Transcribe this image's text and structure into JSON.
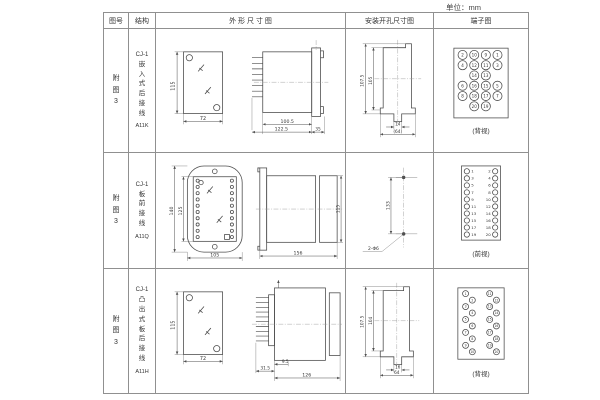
{
  "unit_label": "单位：mm",
  "table": {
    "headers": {
      "fig_no": "图号",
      "structure": "结构",
      "outline": "外 形 尺 寸 图",
      "install": "安装开孔尺寸图",
      "terminal": "端子图"
    },
    "rows": [
      {
        "fig_no": "附图3",
        "structure_model": "CJ-1",
        "structure_desc": "嵌入式后接线",
        "structure_code": "A11K",
        "outline": {
          "front_height": "115",
          "front_width": "72",
          "side_body": "100.5",
          "side_total": "122.5",
          "side_flange": "35"
        },
        "install": {
          "outer_height": "107.5",
          "inner_height": "105",
          "slot_width": "14",
          "opening_width": "(64)"
        },
        "terminal": {
          "view": "(背视)",
          "grid": [
            [
              2,
              10,
              9,
              1
            ],
            [
              4,
              12,
              11,
              3
            ],
            [
              null,
              14,
              13,
              null
            ],
            [
              6,
              16,
              15,
              5
            ],
            [
              8,
              18,
              17,
              7
            ],
            [
              null,
              20,
              19,
              null
            ]
          ]
        }
      },
      {
        "fig_no": "附图3",
        "structure_model": "CJ-1",
        "structure_desc": "板前接线",
        "structure_code": "A11Q",
        "outline": {
          "front_outer_height": "140",
          "front_inner_height": "125",
          "front_width": "105",
          "side_length": "156",
          "side_height": "115"
        },
        "install": {
          "hole_spacing": "133",
          "holes": "2-Φ6"
        },
        "terminal": {
          "view": "(前视)",
          "left_numbers": [
            1,
            3,
            5,
            7,
            9,
            11,
            13,
            15,
            17,
            19
          ],
          "right_numbers": [
            2,
            4,
            6,
            8,
            10,
            12,
            14,
            16,
            18,
            20
          ]
        }
      },
      {
        "fig_no": "附图3",
        "structure_model": "CJ-1",
        "structure_desc": "凸出式板后接线",
        "structure_code": "A11H",
        "outline": {
          "front_height": "115",
          "front_width": "72",
          "pin_depth": "31.5",
          "body_offset": "9.5",
          "side_length": "126"
        },
        "install": {
          "outer_height": "107.5",
          "inner_height": "104",
          "slot_width": "16",
          "opening_width": "64"
        },
        "terminal": {
          "view": "(背视)",
          "left_numbers": [
            1,
            2,
            3,
            4,
            5,
            6,
            7,
            8,
            9,
            10
          ],
          "right_numbers": [
            11,
            12,
            13,
            14,
            15,
            16,
            17,
            18,
            19,
            20
          ]
        }
      }
    ]
  }
}
